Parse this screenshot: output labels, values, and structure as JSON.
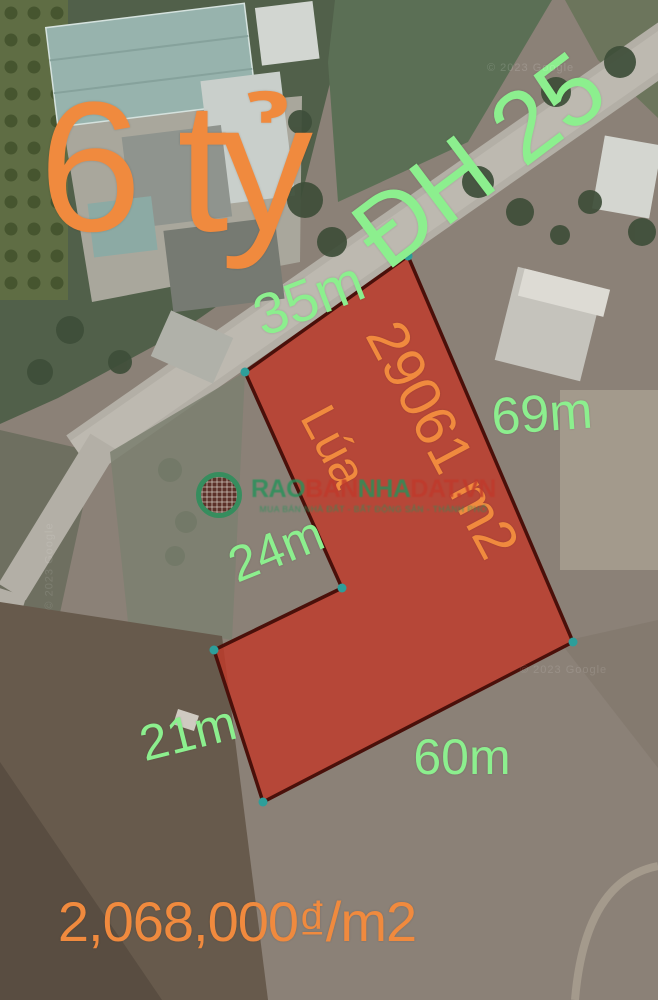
{
  "colors": {
    "label_green": "#8cef8e",
    "label_orange": "#f08a3e",
    "plot_fill": "#c03b2b",
    "plot_stroke": "#4a100a",
    "vertex_dot": "#2d9e9a",
    "watermark_green": "#27915a",
    "watermark_red": "#c0392b"
  },
  "plot": {
    "land_type": "Lúa",
    "area_text": "29061 m2",
    "vertices": [
      [
        408,
        256
      ],
      [
        245,
        372
      ],
      [
        342,
        588
      ],
      [
        214,
        650
      ],
      [
        263,
        802
      ],
      [
        573,
        642
      ]
    ],
    "fill_opacity": 0.82
  },
  "labels": [
    {
      "id": "price-total",
      "text": "6 tỷ",
      "x": 172,
      "y": 168,
      "rot": 0,
      "size": 185,
      "color": "orange"
    },
    {
      "id": "road-name",
      "text": "ĐH 25",
      "x": 479,
      "y": 160,
      "rot": -37,
      "size": 100,
      "color": "green"
    },
    {
      "id": "edge-35m",
      "text": "35m",
      "x": 309,
      "y": 299,
      "rot": -21,
      "size": 58,
      "color": "green"
    },
    {
      "id": "area",
      "text": "29061 m2",
      "x": 442,
      "y": 440,
      "rot": 62,
      "size": 58,
      "color": "orange"
    },
    {
      "id": "land-type",
      "text": "Lúa",
      "x": 334,
      "y": 446,
      "rot": 62,
      "size": 50,
      "color": "orange"
    },
    {
      "id": "edge-69m",
      "text": "69m",
      "x": 542,
      "y": 414,
      "rot": -4,
      "size": 52,
      "color": "green"
    },
    {
      "id": "edge-24m",
      "text": "24m",
      "x": 276,
      "y": 549,
      "rot": -22,
      "size": 50,
      "color": "green"
    },
    {
      "id": "edge-21m",
      "text": "21m",
      "x": 188,
      "y": 733,
      "rot": -14,
      "size": 50,
      "color": "green"
    },
    {
      "id": "edge-60m",
      "text": "60m",
      "x": 462,
      "y": 757,
      "rot": 0,
      "size": 50,
      "color": "green"
    },
    {
      "id": "price-per-m2",
      "text": "2,068,000₫/m2",
      "x": 237,
      "y": 922,
      "rot": 0,
      "size": 56,
      "color": "orange"
    }
  ],
  "watermark": {
    "segments": [
      {
        "text": "RAO",
        "color": "green"
      },
      {
        "text": "BAN",
        "color": "red"
      },
      {
        "text": "NHA",
        "color": "green"
      },
      {
        "text": "DAT.VN",
        "color": "red"
      }
    ],
    "tagline": "MUA BÁN NHÀ ĐẤT - BẤT ĐỘNG SẢN - THÀNH PHỐ"
  },
  "credits": [
    {
      "text": "© 2023 Google",
      "x": 487,
      "y": 62,
      "rot": 0,
      "opacity": 0.35
    },
    {
      "text": "© 2023 Google",
      "x": 520,
      "y": 664,
      "rot": 0,
      "opacity": 0.28
    },
    {
      "text": "© 2023 Google",
      "x": 6,
      "y": 560,
      "rot": -90,
      "opacity": 0.25
    }
  ]
}
